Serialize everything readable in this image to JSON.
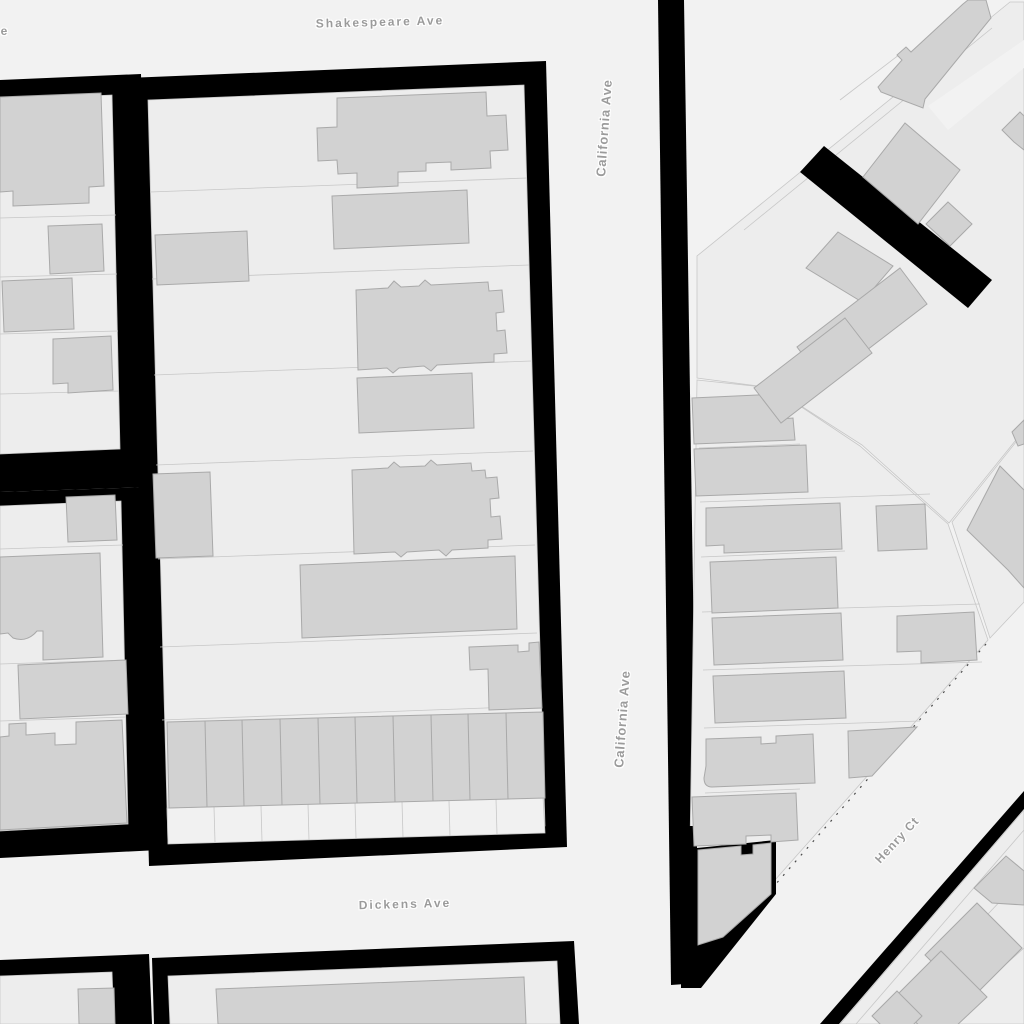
{
  "map": {
    "style": "monochrome-figure-ground-street-map",
    "colors": {
      "street": "#f2f2f2",
      "parcel": "#ededed",
      "parcel_line": "#c7c7c7",
      "building": "#d2d2d2",
      "building_outline": "#a9a9a9",
      "block": "#000000",
      "label": "#9b9b9b",
      "label_halo": "#ffffff"
    },
    "street_labels": [
      {
        "id": "shakespeare-ave",
        "text": "Shakespeare Ave",
        "orientation": "horizontal"
      },
      {
        "id": "california-ave-north",
        "text": "California Ave",
        "orientation": "vertical"
      },
      {
        "id": "california-ave-south",
        "text": "California Ave",
        "orientation": "vertical"
      },
      {
        "id": "dickens-ave",
        "text": "Dickens Ave",
        "orientation": "horizontal"
      },
      {
        "id": "henry-ct",
        "text": "Henry Ct",
        "orientation": "diagonal"
      },
      {
        "id": "left-edge-label-fragment",
        "text": "e",
        "orientation": "horizontal"
      }
    ]
  }
}
